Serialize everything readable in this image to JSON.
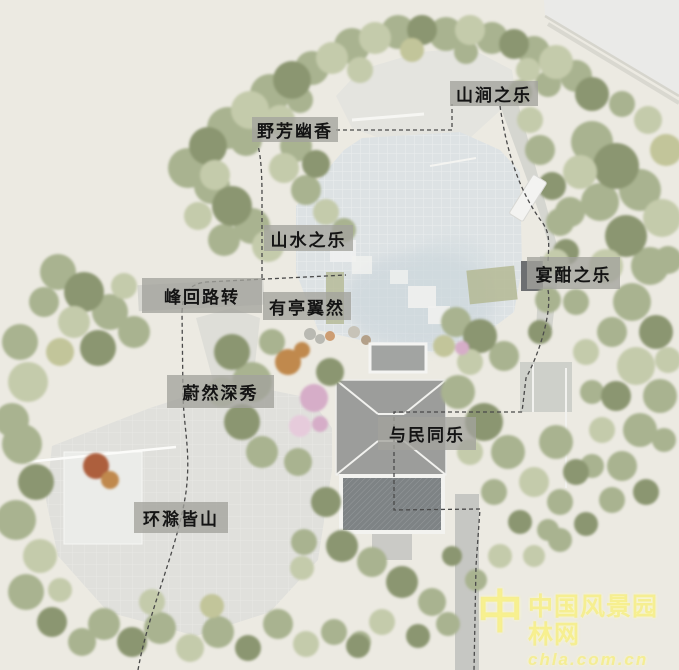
{
  "scene_labels": [
    {
      "text": "山涧之乐"
    },
    {
      "text": "野芳幽香"
    },
    {
      "text": "山水之乐"
    },
    {
      "text": "宴酣之乐"
    },
    {
      "text": "峰回路转"
    },
    {
      "text": "有亭翼然"
    },
    {
      "text": "蔚然深秀"
    },
    {
      "text": "与民同乐"
    },
    {
      "text": "环滁皆山"
    }
  ],
  "watermark": {
    "logo_char": "中",
    "site_name": "中国风景园林网",
    "site_url": "chla.com.cn"
  },
  "colors": {
    "background": "#eceae2",
    "label_background": "#a3a39c",
    "label_text": "#141414",
    "route_line": "#4a4a4a",
    "tree_green": "#a9b390",
    "tree_dark": "#8b9671",
    "tree_light": "#c4cbab",
    "plaza_blue_gray": "#dde2e4",
    "plaza_light": "#e0e0dc",
    "building_gray": "#9c9d9b",
    "watermark_yellow": "#f3ea6e"
  }
}
